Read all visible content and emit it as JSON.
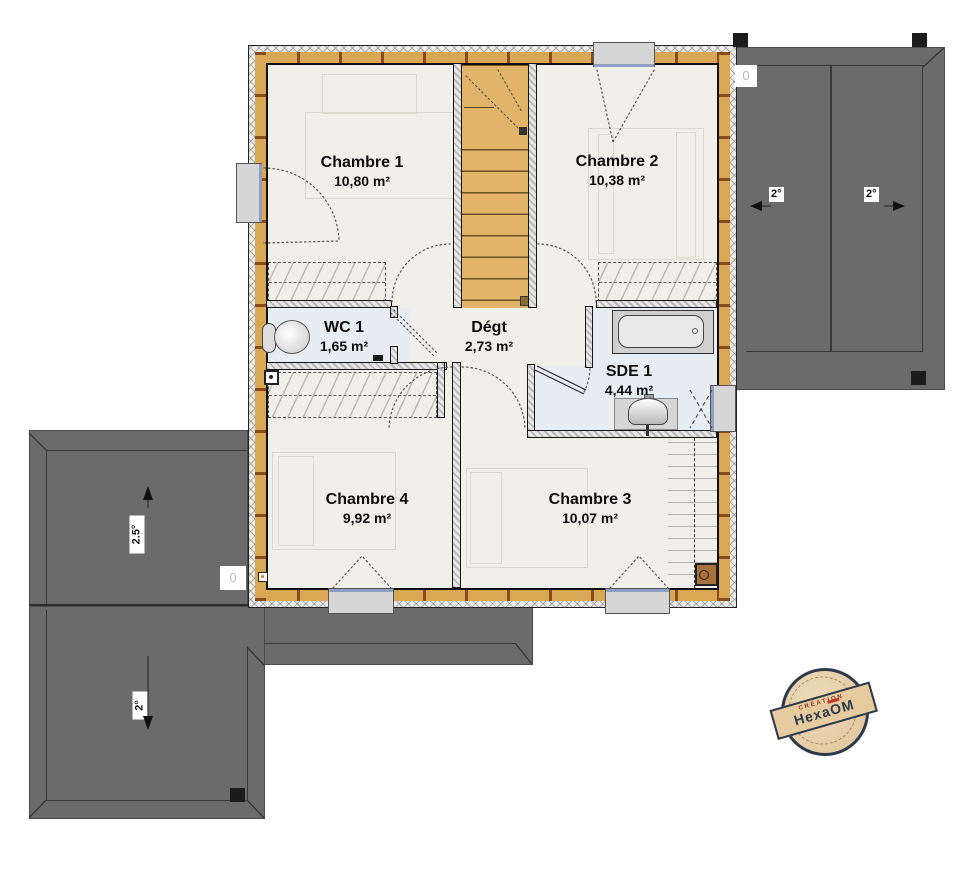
{
  "rooms": [
    {
      "name": "Chambre 1",
      "area": "10,80 m²"
    },
    {
      "name": "Chambre 2",
      "area": "10,38 m²"
    },
    {
      "name": "WC 1",
      "area": "1,65 m²"
    },
    {
      "name": "Dégt",
      "area": "2,73 m²"
    },
    {
      "name": "SDE 1",
      "area": "4,44 m²"
    },
    {
      "name": "Chambre 4",
      "area": "9,92 m²"
    },
    {
      "name": "Chambre 3",
      "area": "10,07 m²"
    }
  ],
  "roof": {
    "right_panel_left": "2°",
    "right_panel_right": "2°",
    "left_upper": "2.5°",
    "left_lower": "2°"
  },
  "markers": {
    "top_right": "0",
    "bottom_left": "0"
  },
  "logo": {
    "creation": "CRÉATION",
    "brand_prefix": "Hexa",
    "brand_o": "O",
    "brand_suffix": "M"
  },
  "colors": {
    "roof_gray": "#6b6b6b",
    "wall_wood": "#d8a855",
    "wall_wood_block": "#8a4a1c",
    "stair": "#e2b469",
    "wet_floor": "#e8edf1",
    "floor": "#f1efe9",
    "logo_navy": "#2c3a4c",
    "logo_red": "#c0392b",
    "logo_beige": "#e6d0a9"
  }
}
